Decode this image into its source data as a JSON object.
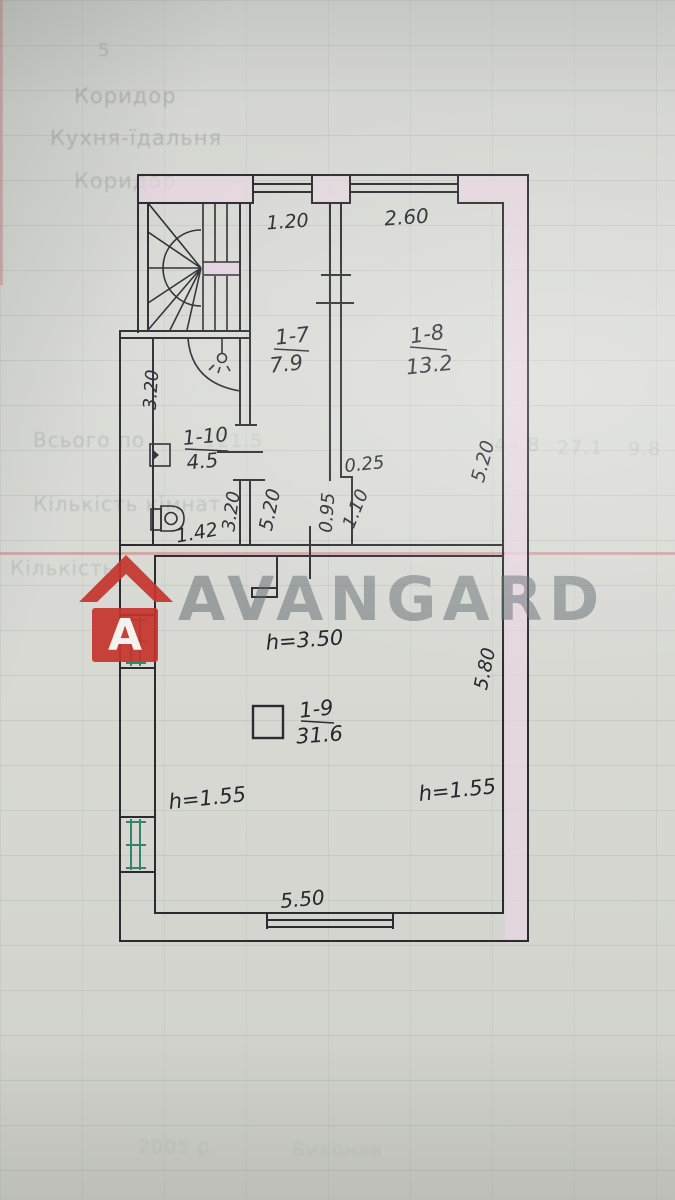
{
  "watermark": {
    "brand": "AVANGARD",
    "logo_letter": "A"
  },
  "plan": {
    "rooms": {
      "r17": {
        "number": "1-7",
        "area": "7.9"
      },
      "r18": {
        "number": "1-8",
        "area": "13.2"
      },
      "r19": {
        "number": "1-9",
        "area": "31.6"
      },
      "r110": {
        "number": "1-10",
        "area": "4.5"
      }
    },
    "dims": {
      "win_17": "1.20",
      "win_18": "2.60",
      "bath_left": "3.20",
      "bath_right": "3.20",
      "bath_width": "1.42",
      "corridor_len": "5.20",
      "room18_len": "5.20",
      "step": "0.25",
      "opening_left": "0.95",
      "opening_right": "1.10",
      "room19_len": "5.80",
      "room19_width": "5.50",
      "ceil_main": "h=3.50",
      "ceil_left": "h=1.55",
      "ceil_right": "h=1.55"
    }
  },
  "background": {
    "col_num": "5",
    "rows": {
      "row1": "Коридор",
      "row2": "Кухня-їдальня",
      "row3": "Коридор",
      "row4": "Всього по",
      "row5": "Кількість кімнат",
      "row6": "Кількість"
    },
    "numbers": {
      "n1": "121.5",
      "n2": "44.8",
      "n3": "27.1",
      "n4": "9.8"
    },
    "footer": {
      "f1": "2005 р.",
      "f2": "Виконав"
    }
  }
}
